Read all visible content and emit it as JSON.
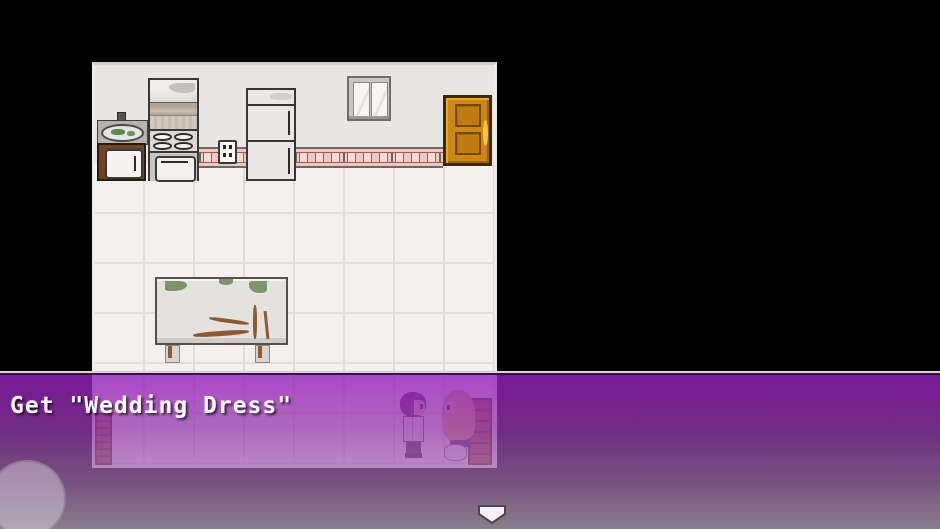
{
  "message_box": {
    "text": "Get \"Wedding Dress\""
  },
  "scene": {
    "name": "kitchen-room",
    "objects": [
      {
        "name": "sink-cabinet"
      },
      {
        "name": "stove-oven"
      },
      {
        "name": "power-outlet"
      },
      {
        "name": "refrigerator"
      },
      {
        "name": "window"
      },
      {
        "name": "door"
      },
      {
        "name": "backsplash-tiles"
      },
      {
        "name": "kitchen-table"
      },
      {
        "name": "bookshelf"
      },
      {
        "name": "dresser"
      },
      {
        "name": "groom-character"
      },
      {
        "name": "bride-character"
      }
    ]
  },
  "hud": {
    "continue_arrow_icon": "down-arrow",
    "joystick_button": "touch-circle"
  },
  "colors": {
    "background": "#000000",
    "wall": "#e8e6e4",
    "floor": "#f3f1ef",
    "backsplash_pink": "#ecc9c3",
    "tile_red": "#bf4f46",
    "door_orange": "#cd8712",
    "overlay_purple_top": "#981cc0",
    "overlay_bottom": "#d0c0d4",
    "text": "#ffffff"
  }
}
